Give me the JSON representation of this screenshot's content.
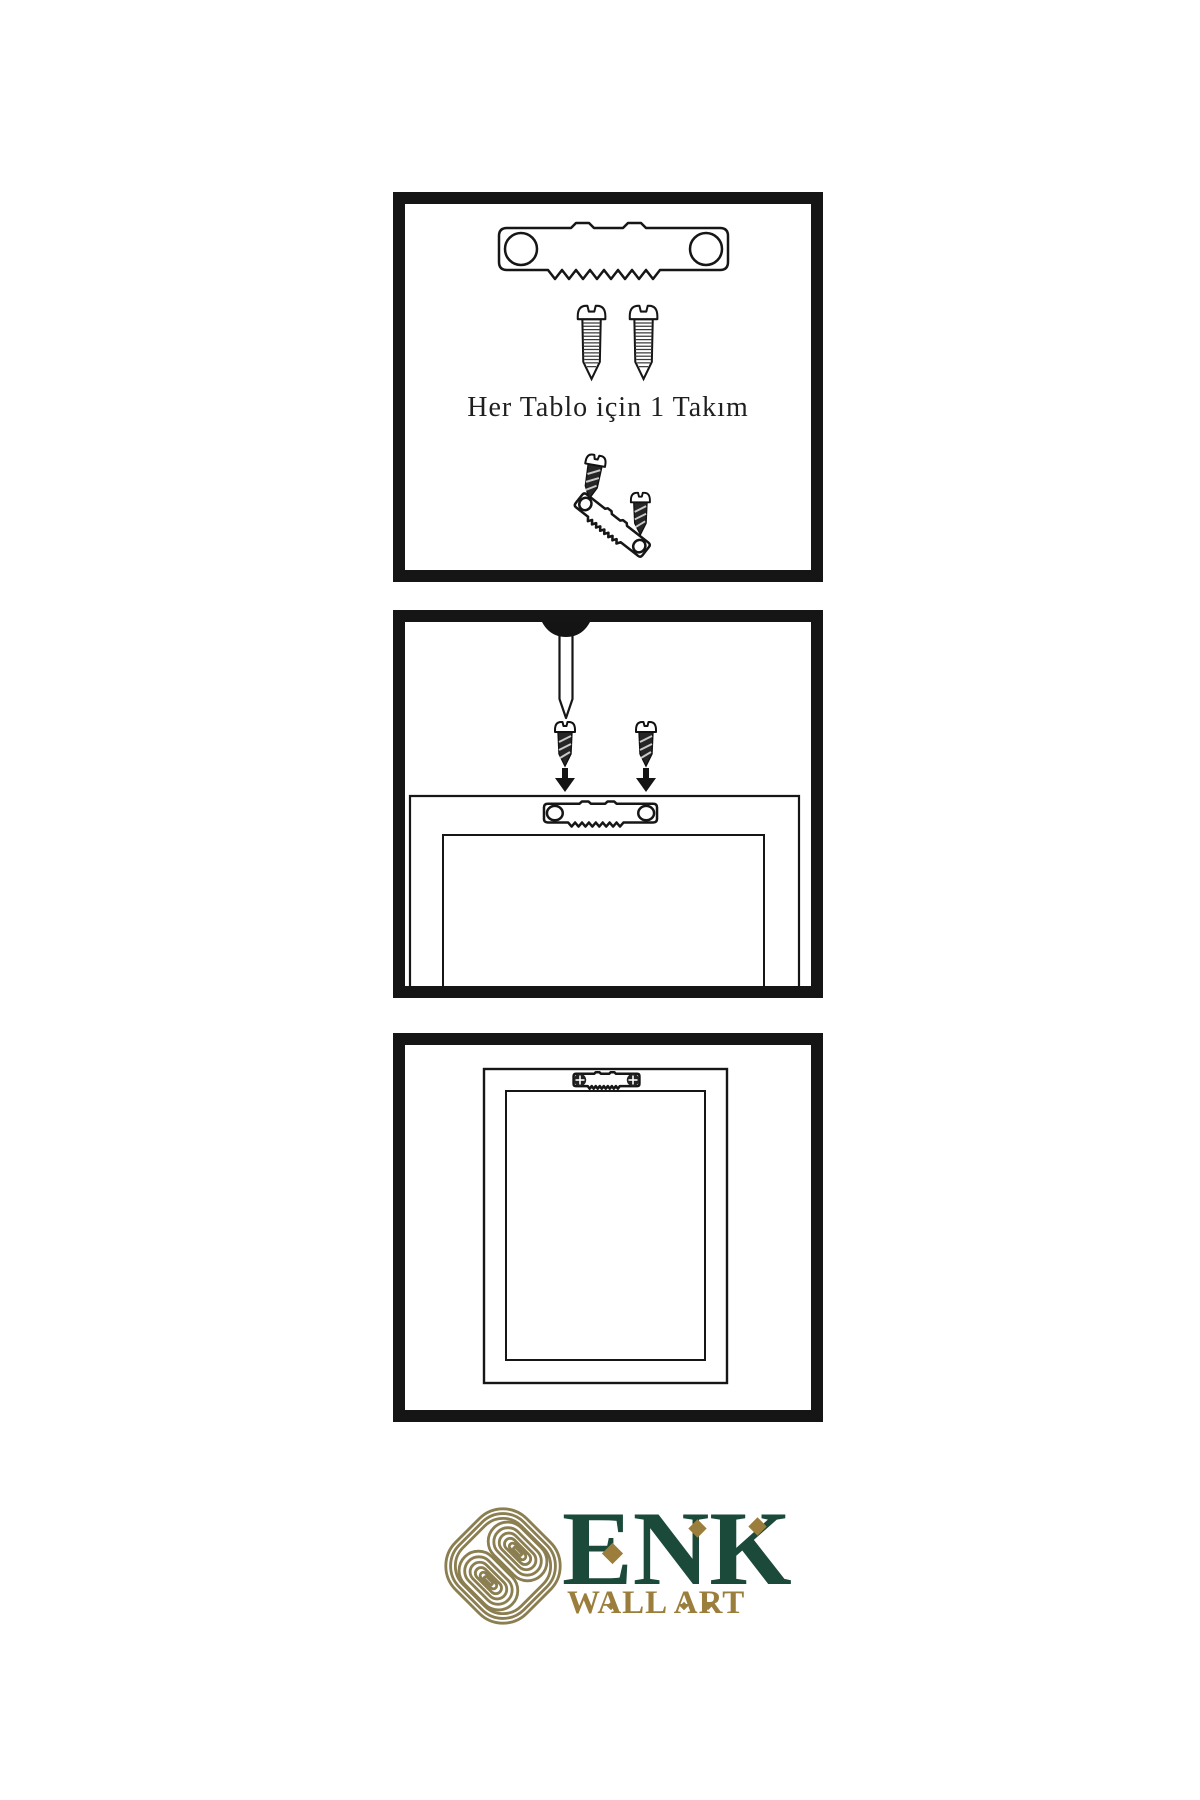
{
  "page": {
    "background_color": "#ffffff",
    "line_color": "#161616",
    "description": "Wall art hanging hardware instruction sheet with three diagram panels and brand logo"
  },
  "panels": {
    "kit": {
      "instruction_text": "Her Tablo için 1 Takım",
      "items": [
        "sawtooth-hanger",
        "mounting-screw",
        "mounting-screw",
        "hanger-assembly-with-screws"
      ]
    },
    "install": {
      "items": [
        "wall-nail",
        "mounting-screw",
        "mounting-screw",
        "down-arrow",
        "down-arrow",
        "frame-back-with-sawtooth-hanger"
      ]
    },
    "result": {
      "items": [
        "wall-mounted-frame-with-sawtooth-hanger-and-screws"
      ]
    }
  },
  "logo": {
    "brand_name": "ENK",
    "tagline": "WALL ART",
    "symbol": "interlocking-knot",
    "colors": {
      "brand_green": "#1b493a",
      "gold": "#9c7e3c",
      "knot_gold": "#8b7e50"
    }
  }
}
